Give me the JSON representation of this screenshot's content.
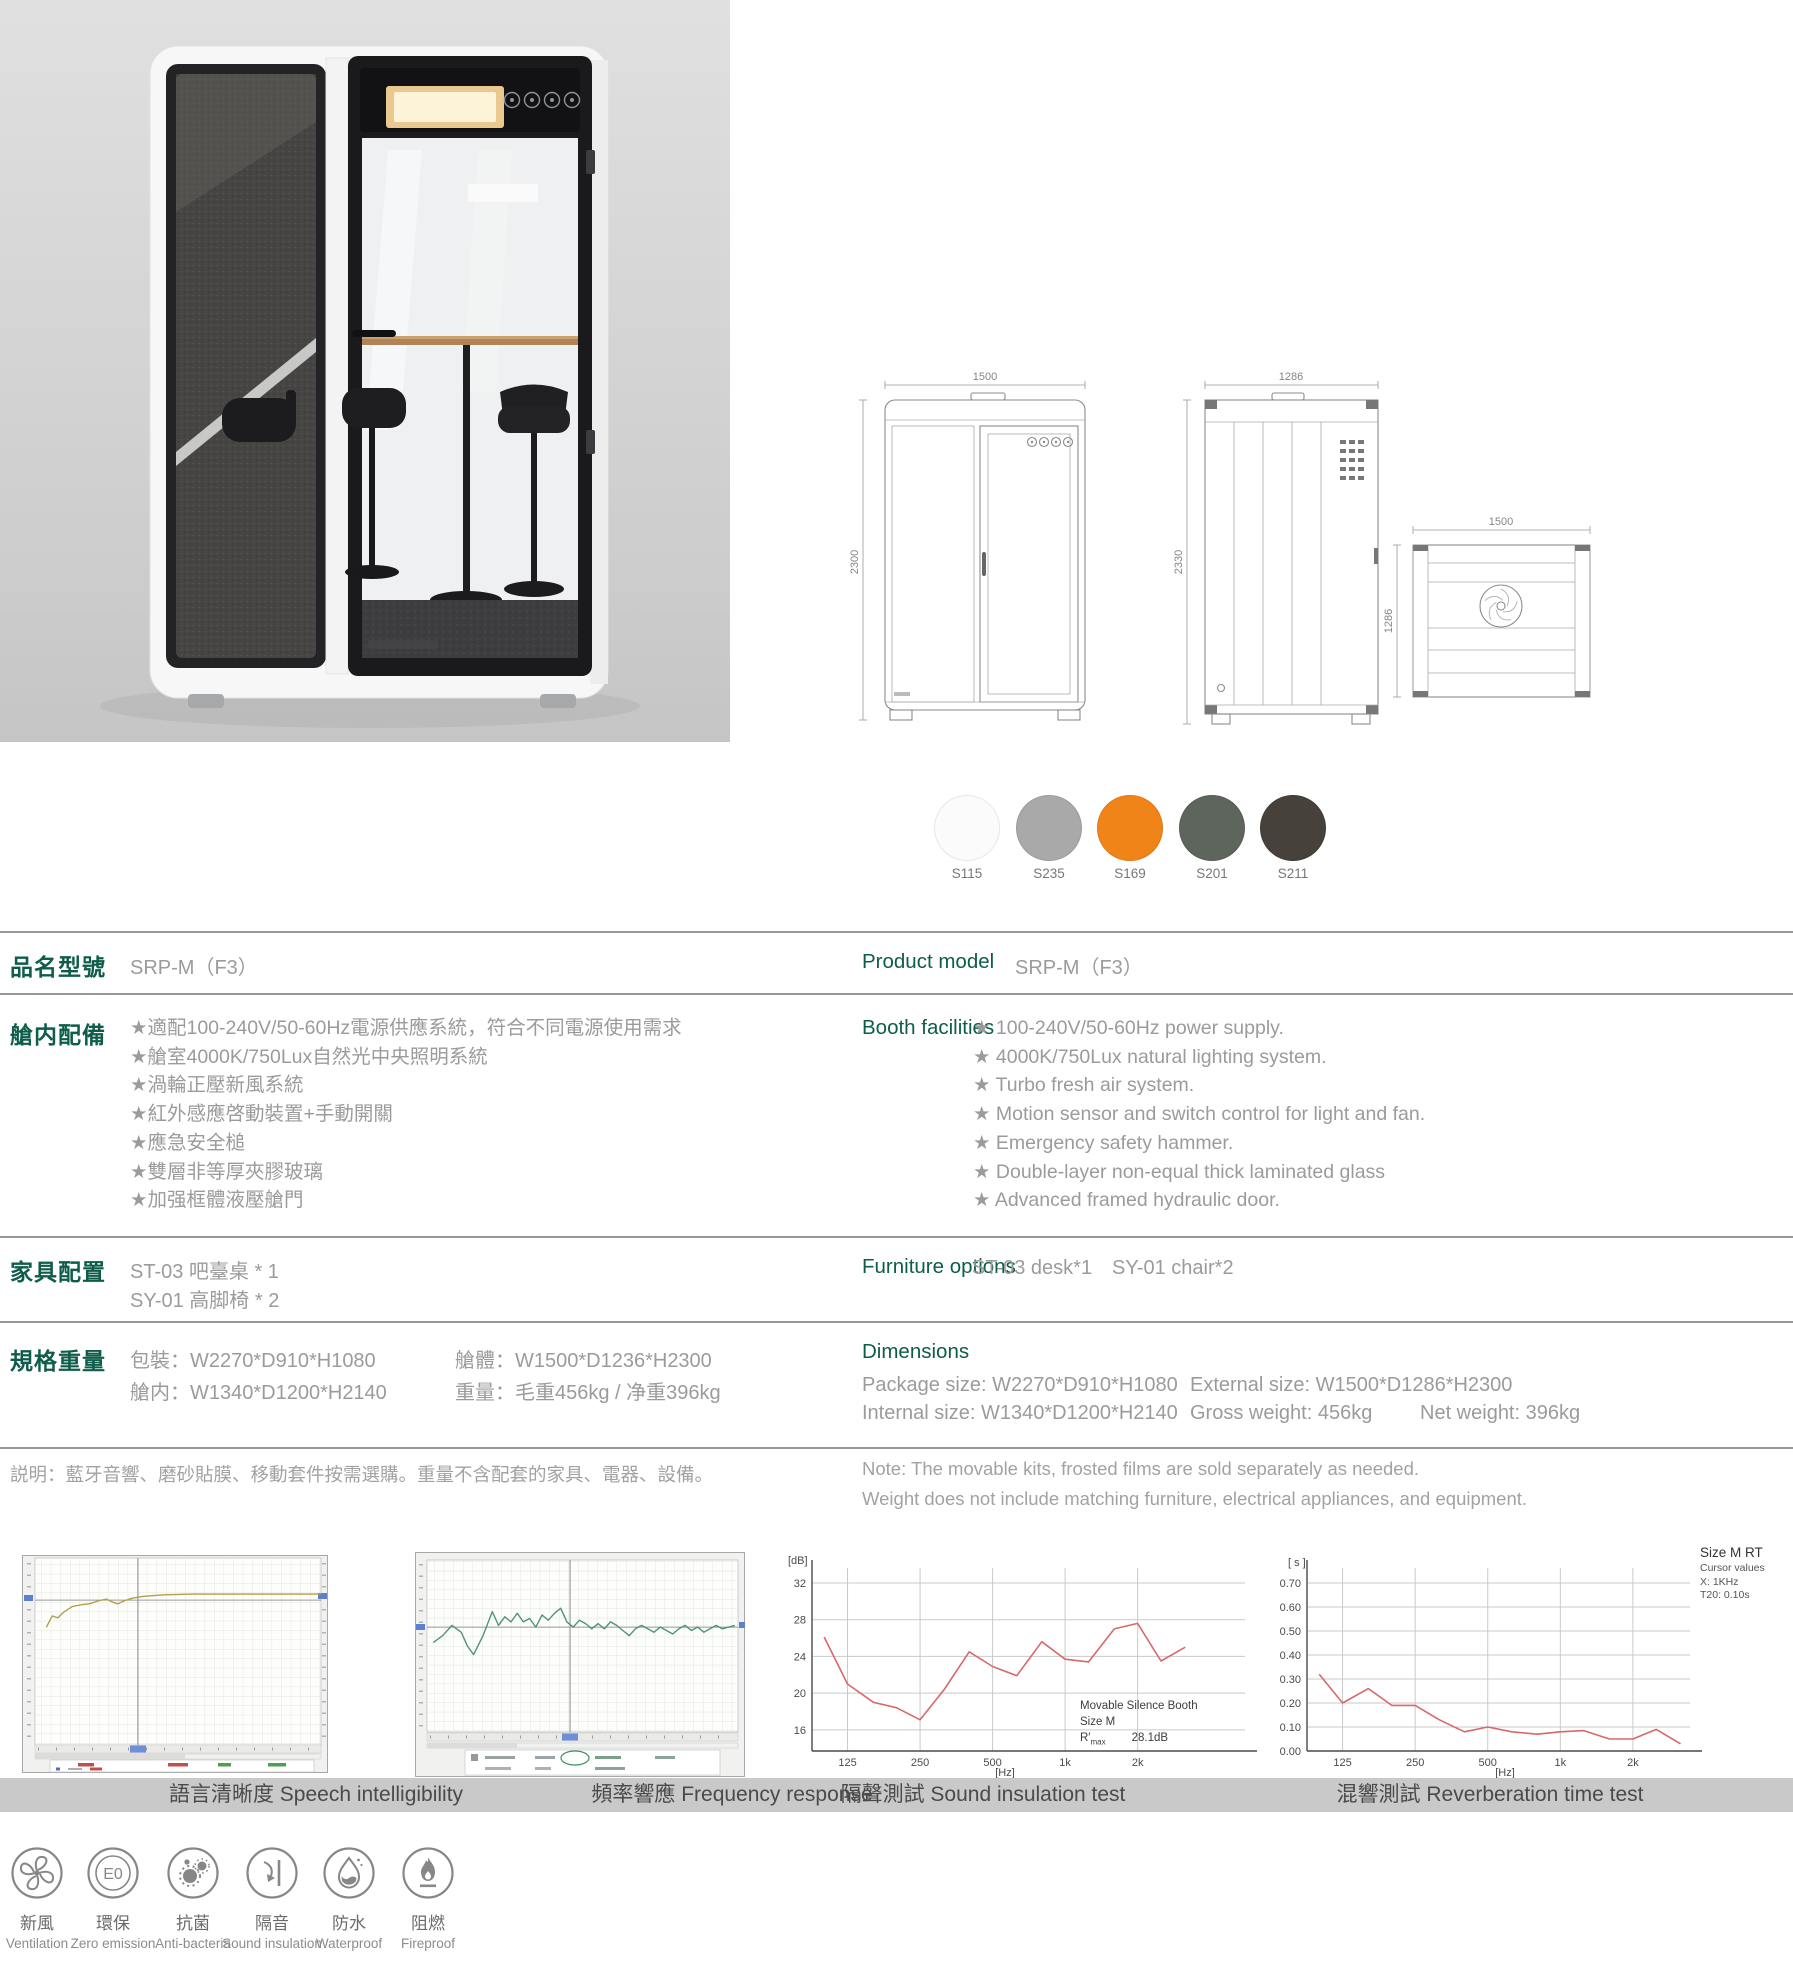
{
  "colors": {
    "accent_green": "#0e5c4a",
    "body_text_gray": "#9b9b9b",
    "caption_bar": "#c9c9c9",
    "chart_line_red": "#d6696b"
  },
  "swatches": [
    {
      "code": "S115",
      "color": "#fbfbfb"
    },
    {
      "code": "S235",
      "color": "#a9a9a9"
    },
    {
      "code": "S169",
      "color": "#f08418"
    },
    {
      "code": "S201",
      "color": "#5d655c"
    },
    {
      "code": "S211",
      "color": "#46413b"
    }
  ],
  "drawings": {
    "front": {
      "width": "1500",
      "height": "2300"
    },
    "side": {
      "width": "1286",
      "height": "2330"
    },
    "top": {
      "width": "1500",
      "depth": "1286"
    }
  },
  "table": {
    "model": {
      "cn_label": "品名型號",
      "en_label": "Product model",
      "value": "SRP-M（F3）"
    },
    "facilities": {
      "cn_label": "艙内配備",
      "en_label": "Booth facilities",
      "cn_items": [
        "★適配100-240V/50-60Hz電源供應系統，符合不同電源使用需求",
        "★艙室4000K/750Lux自然光中央照明系統",
        "★渦輪正壓新風系統",
        "★紅外感應啓動裝置+手動開關",
        "★應急安全槌",
        "★雙層非等厚夾膠玻璃",
        "★加强框體液壓艙門"
      ],
      "en_items": [
        "★ 100-240V/50-60Hz power supply.",
        "★ 4000K/750Lux natural lighting system.",
        "★ Turbo fresh air system.",
        "★ Motion sensor and switch control for light and fan.",
        "★ Emergency safety hammer.",
        "★ Double-layer non-equal thick laminated glass",
        "★ Advanced framed hydraulic door."
      ]
    },
    "furniture": {
      "cn_label": "家具配置",
      "en_label": "Furniture options",
      "cn_items": [
        "ST-03 吧臺桌 * 1",
        "SY-01 高脚椅 * 2"
      ],
      "en_items": [
        "ST-03 desk*1",
        "SY-01 chair*2"
      ]
    },
    "specs": {
      "cn_label": "規格重量",
      "en_heading": "Dimensions",
      "cn_package": "包裝：W2270*D910*H1080",
      "cn_body": "艙體：W1500*D1236*H2300",
      "cn_internal": "艙内：W1340*D1200*H2140",
      "cn_weight": "重量：毛重456kg / 净重396kg",
      "en_package": "Package size: W2270*D910*H1080",
      "en_external": "External size: W1500*D1286*H2300",
      "en_internal": "Internal size: W1340*D1200*H2140",
      "en_gross": "Gross weight: 456kg",
      "en_net": "Net weight: 396kg"
    },
    "note": {
      "cn": "説明：藍牙音響、磨砂貼膜、移動套件按需選購。重量不含配套的家具、電器、設備。",
      "en_line1": "Note:  The movable kits, frosted films are sold separately as needed.",
      "en_line2": "Weight does not include matching furniture, electrical appliances, and equipment."
    }
  },
  "badges": [
    {
      "cn": "新風",
      "en": "Ventilation"
    },
    {
      "cn": "環保",
      "en": "Zero emission",
      "inner": "E0"
    },
    {
      "cn": "抗菌",
      "en": "Anti-bacteria"
    },
    {
      "cn": "隔音",
      "en": "Sound insulation"
    },
    {
      "cn": "防水",
      "en": "Waterproof"
    },
    {
      "cn": "阻燃",
      "en": "Fireproof"
    }
  ],
  "chart_data": [
    {
      "type": "line",
      "style": "analyzer-screenshot",
      "caption": "語言清晰度 Speech intelligibility",
      "cursor": {
        "x_pct": 36,
        "y_pct": 22.5
      },
      "series": [
        {
          "name": "speech-intelligibility-curve",
          "color": "#b3a04c",
          "points_pct": [
            [
              4,
              37
            ],
            [
              6,
              31
            ],
            [
              8,
              32
            ],
            [
              10,
              29
            ],
            [
              13,
              26
            ],
            [
              16,
              25
            ],
            [
              19,
              24.5
            ],
            [
              22,
              23
            ],
            [
              25,
              22
            ],
            [
              27,
              23.5
            ],
            [
              29,
              24.5
            ],
            [
              31,
              23
            ],
            [
              34,
              21.5
            ],
            [
              38,
              20.5
            ],
            [
              45,
              19.7
            ],
            [
              55,
              19.3
            ],
            [
              100,
              19.3
            ]
          ]
        }
      ]
    },
    {
      "type": "line",
      "style": "analyzer-screenshot",
      "caption": "頻率響應 Frequency response",
      "cursor": {
        "x_pct": 46,
        "y_pct": 39
      },
      "series": [
        {
          "name": "frequency-response-curve",
          "color": "#4e9479",
          "points_pct": [
            [
              2,
              48
            ],
            [
              5,
              44
            ],
            [
              8,
              38
            ],
            [
              11,
              42
            ],
            [
              13,
              50
            ],
            [
              15,
              55
            ],
            [
              18,
              44
            ],
            [
              21,
              30
            ],
            [
              23,
              38
            ],
            [
              25,
              33
            ],
            [
              27,
              36
            ],
            [
              29,
              31
            ],
            [
              31,
              36
            ],
            [
              33,
              34
            ],
            [
              35,
              39
            ],
            [
              37,
              32
            ],
            [
              39,
              35
            ],
            [
              41,
              31
            ],
            [
              43,
              28
            ],
            [
              45,
              36
            ],
            [
              47,
              39
            ],
            [
              49,
              35
            ],
            [
              51,
              37
            ],
            [
              53,
              40
            ],
            [
              55,
              37
            ],
            [
              57,
              40
            ],
            [
              59,
              36
            ],
            [
              61,
              38
            ],
            [
              63,
              41
            ],
            [
              65,
              44
            ],
            [
              67,
              40
            ],
            [
              69,
              38
            ],
            [
              71,
              40
            ],
            [
              73,
              42
            ],
            [
              75,
              39
            ],
            [
              77,
              41
            ],
            [
              79,
              43
            ],
            [
              81,
              40
            ],
            [
              83,
              38
            ],
            [
              85,
              41
            ],
            [
              87,
              39
            ],
            [
              89,
              42
            ],
            [
              91,
              40
            ],
            [
              93,
              38
            ],
            [
              95,
              40
            ],
            [
              97,
              39
            ],
            [
              99,
              38
            ]
          ]
        }
      ]
    },
    {
      "type": "line",
      "style": "acoustic",
      "caption": "隔聲測試 Sound insulation test",
      "ylabel": "[dB]",
      "xlabel": "[Hz]",
      "x_tick_labels": [
        "125",
        "250",
        "500",
        "1k",
        "2k"
      ],
      "x_tick_hz": [
        125,
        250,
        500,
        1000,
        2000
      ],
      "y_tick_labels": [
        "32",
        "28",
        "24",
        "20",
        "16"
      ],
      "y_tick_values": [
        32,
        28,
        24,
        20,
        16
      ],
      "xlim_hz": [
        89,
        5580
      ],
      "y_top_value": 34.5,
      "y_bottom_value": 13.7,
      "freq_hz": [
        100,
        125,
        160,
        200,
        250,
        315,
        400,
        500,
        630,
        800,
        1000,
        1250,
        1600,
        2000,
        2500,
        3150
      ],
      "values": [
        26.1,
        21.0,
        19.0,
        18.4,
        17.1,
        20.4,
        24.5,
        22.9,
        21.9,
        25.6,
        23.7,
        23.4,
        27.0,
        27.6,
        23.5,
        25.0
      ],
      "line_color": "#d6696b",
      "annotation": {
        "line1": "Movable Silence Booth",
        "line2": "Size M",
        "r_prefix": "R′",
        "r_sub": "max",
        "r_value": "28.1dB"
      }
    },
    {
      "type": "line",
      "style": "acoustic",
      "caption": "混響測試 Reverberation time test",
      "ylabel": "[ s ]",
      "xlabel": "[Hz]",
      "x_tick_labels": [
        "125",
        "250",
        "500",
        "1k",
        "2k"
      ],
      "x_tick_hz": [
        125,
        250,
        500,
        1000,
        2000
      ],
      "y_tick_labels": [
        "0.70",
        "0.60",
        "0.50",
        "0.40",
        "0.30",
        "0.20",
        "0.10",
        "0.00"
      ],
      "y_tick_values": [
        0.7,
        0.6,
        0.5,
        0.4,
        0.3,
        0.2,
        0.1,
        0.0
      ],
      "xlim_hz": [
        89,
        3450
      ],
      "y_top_value": 0.8,
      "y_bottom_value": 0.0,
      "freq_hz": [
        100,
        125,
        160,
        200,
        250,
        315,
        400,
        500,
        630,
        800,
        1000,
        1250,
        1600,
        2000,
        2500,
        3150
      ],
      "values": [
        0.32,
        0.2,
        0.26,
        0.19,
        0.19,
        0.13,
        0.08,
        0.1,
        0.08,
        0.07,
        0.08,
        0.085,
        0.05,
        0.05,
        0.09,
        0.03
      ],
      "line_color": "#d6696b",
      "legend": {
        "line1": "Size M RT",
        "line2": "Cursor values",
        "line3": "X: 1KHz",
        "line4": "T20: 0.10s"
      }
    }
  ]
}
